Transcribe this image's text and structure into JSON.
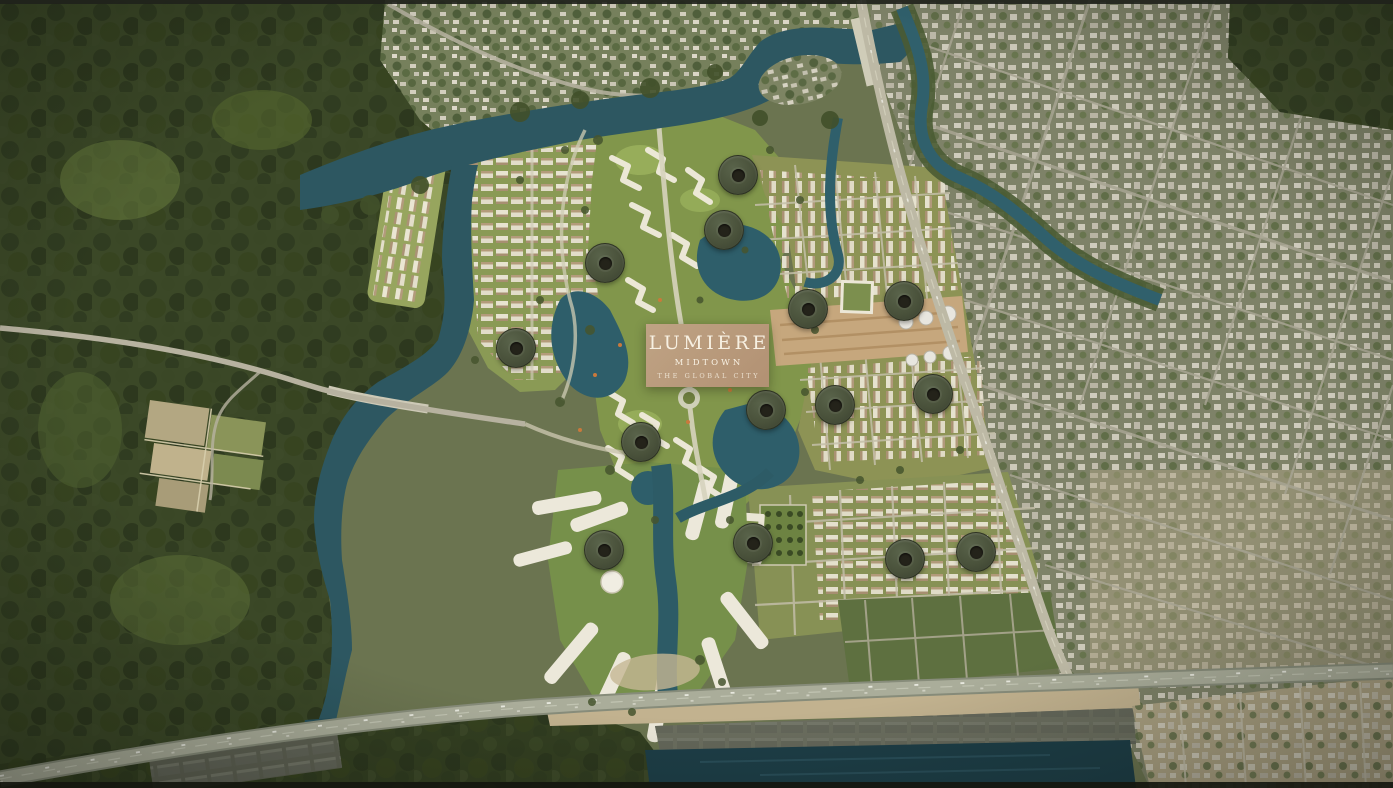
{
  "page": {
    "title": "Lumière Midtown — The Global City masterplan",
    "view": "aerial-masterplan-render"
  },
  "badge": {
    "brand": "LUMIÈRE",
    "division": "MIDTOWN",
    "tagline": "THE GLOBAL CITY",
    "background": "#b69877",
    "text_color": "#f7f0e2",
    "x": 646,
    "y": 324,
    "width": 123,
    "height": 63
  },
  "map": {
    "hotspot_style": {
      "diameter": 38,
      "outer_color": "#4a523b",
      "inner_color": "#24231a",
      "inner_diameter": 13
    },
    "hotspots": [
      {
        "id": 1,
        "x": 737,
        "y": 174
      },
      {
        "id": 2,
        "x": 723,
        "y": 229
      },
      {
        "id": 3,
        "x": 604,
        "y": 262
      },
      {
        "id": 4,
        "x": 515,
        "y": 347
      },
      {
        "id": 5,
        "x": 807,
        "y": 308
      },
      {
        "id": 6,
        "x": 903,
        "y": 300
      },
      {
        "id": 7,
        "x": 765,
        "y": 409
      },
      {
        "id": 8,
        "x": 834,
        "y": 404
      },
      {
        "id": 9,
        "x": 932,
        "y": 393
      },
      {
        "id": 10,
        "x": 640,
        "y": 441
      },
      {
        "id": 11,
        "x": 603,
        "y": 549
      },
      {
        "id": 12,
        "x": 752,
        "y": 542
      },
      {
        "id": 13,
        "x": 904,
        "y": 558
      },
      {
        "id": 14,
        "x": 975,
        "y": 551
      }
    ],
    "palette": {
      "forest": "#3b4827",
      "park_green": "#81964b",
      "water": "#2d5761",
      "water_dark": "#1d3e47",
      "city_east": "#7e8268",
      "road": "#b4b09c",
      "highway": "#a7aa97",
      "construction_dirt": "#c6a77d",
      "sand": "#c1b291"
    }
  }
}
